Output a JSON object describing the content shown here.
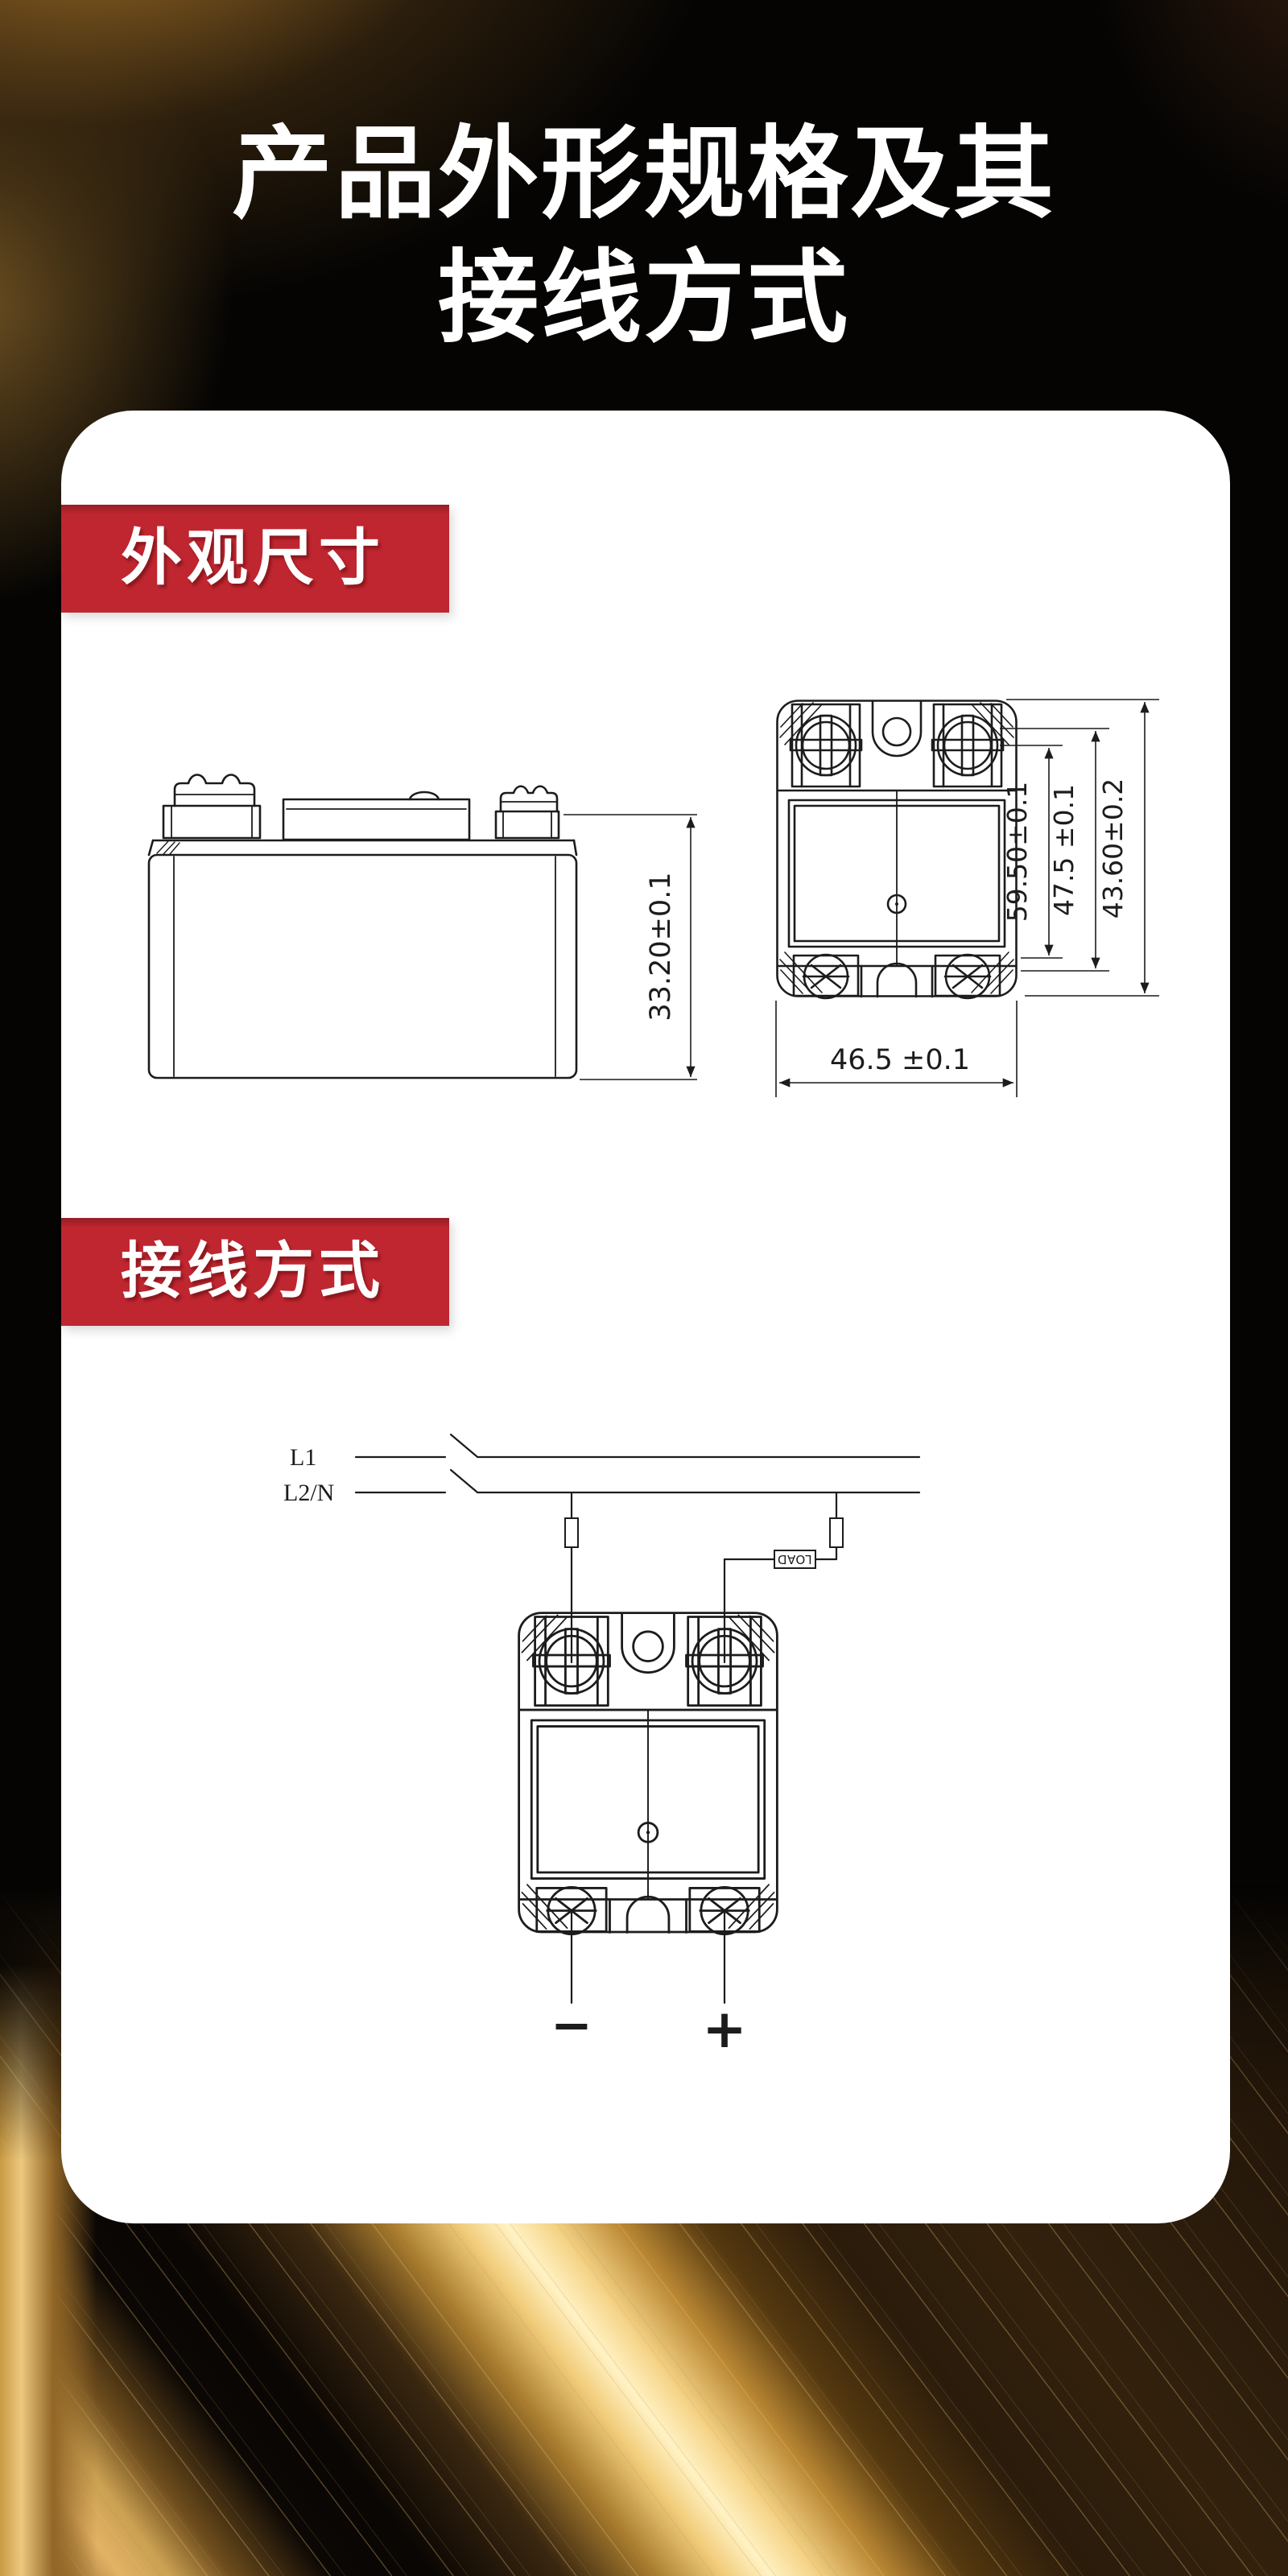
{
  "page": {
    "title_line1": "产品外形规格及其",
    "title_line2": "接线方式"
  },
  "appearance_section": {
    "badge_label": "外观尺寸",
    "side_view": {
      "dim_height": "33.20±0.1"
    },
    "front_view": {
      "dim_inner": "59.50±0.1",
      "dim_middle": "47.5 ±0.1",
      "dim_outer": "43.60±0.2",
      "dim_width": "46.5 ±0.1"
    }
  },
  "wiring_section": {
    "badge_label": "接线方式",
    "line1_label": "L1",
    "line2_label": "L2/N",
    "load_label": "LOAD",
    "minus_label": "−",
    "plus_label": "+"
  },
  "colors": {
    "badge_red": "#bf2630",
    "card_white": "#ffffff",
    "drawing_ink": "#1c1c1c",
    "gold_accent": "#e9bd6a"
  }
}
